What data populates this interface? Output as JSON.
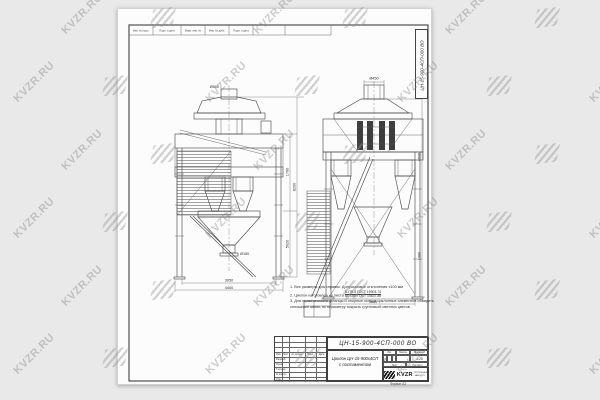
{
  "watermark": {
    "text": "KVZR.RU"
  },
  "corner_designation": "ЦН-15-900-4СП-000 ВО",
  "top_strip": {
    "c1": "Инв. № подл.",
    "c2": "Подп. и дата",
    "c3": "Взам. инв. №",
    "c4": "Инв. № дубл.",
    "c5": "Подп. и дата"
  },
  "left_view": {
    "dim_stub": "Ø500",
    "dim_outlet": "Ø150",
    "dim_bottom_inner": "3050",
    "dim_bottom_outer": "4400",
    "dim_right_upper": "1700",
    "dim_right_lower": "5020",
    "dim_right_overall": "8200"
  },
  "right_view": {
    "dim_stub": "Ø450",
    "dim_bottom": "3640",
    "dim_right_upper": "4600",
    "dim_right_lower": "1380"
  },
  "notes": {
    "line1": "1. Все размеры для справок. Допускаемые отклонения ±100 мм",
    "line2_prefix": "2. Циклон изготовлен из листа",
    "frac_top": "Б-ПН-5 ГОСТ 19903-74",
    "frac_bottom": "ВСт3сп ГОСТ 14637-89",
    "line3": "3. Для герметичности фланцы и опорные кольца циклонных элементов обварить",
    "line4": "сплошным швом, по периметру покрыть грунтовкой светлых цветов."
  },
  "title_block": {
    "designation": "ЦН-15-900-4СП-000 ВО",
    "name_line1": "Циклон ЦН-15-900х4СП",
    "name_line2": "с постаментом",
    "col_izm": "Изм.",
    "col_list": "Лист",
    "col_doc": "№ докум.",
    "col_sign": "Подп.",
    "col_date": "Дата",
    "row_razrab": "Разраб.",
    "row_prov": "Пров.",
    "row_tkontr": "Т.контр.",
    "row_nkontr": "Н.контр.",
    "row_utv": "Утв.",
    "lit": "Лит.",
    "mass": "Масса",
    "scale": "Масштаб",
    "lit_value": "у",
    "scale_value": "1:20",
    "sheet": "Лист",
    "sheets": "Листов 1",
    "logo_text": "KVZR",
    "org_line1": "КОТЕЛЬНЫЙ",
    "org_line2": "ЗАВОД.РУ",
    "format": "Формат А3"
  }
}
